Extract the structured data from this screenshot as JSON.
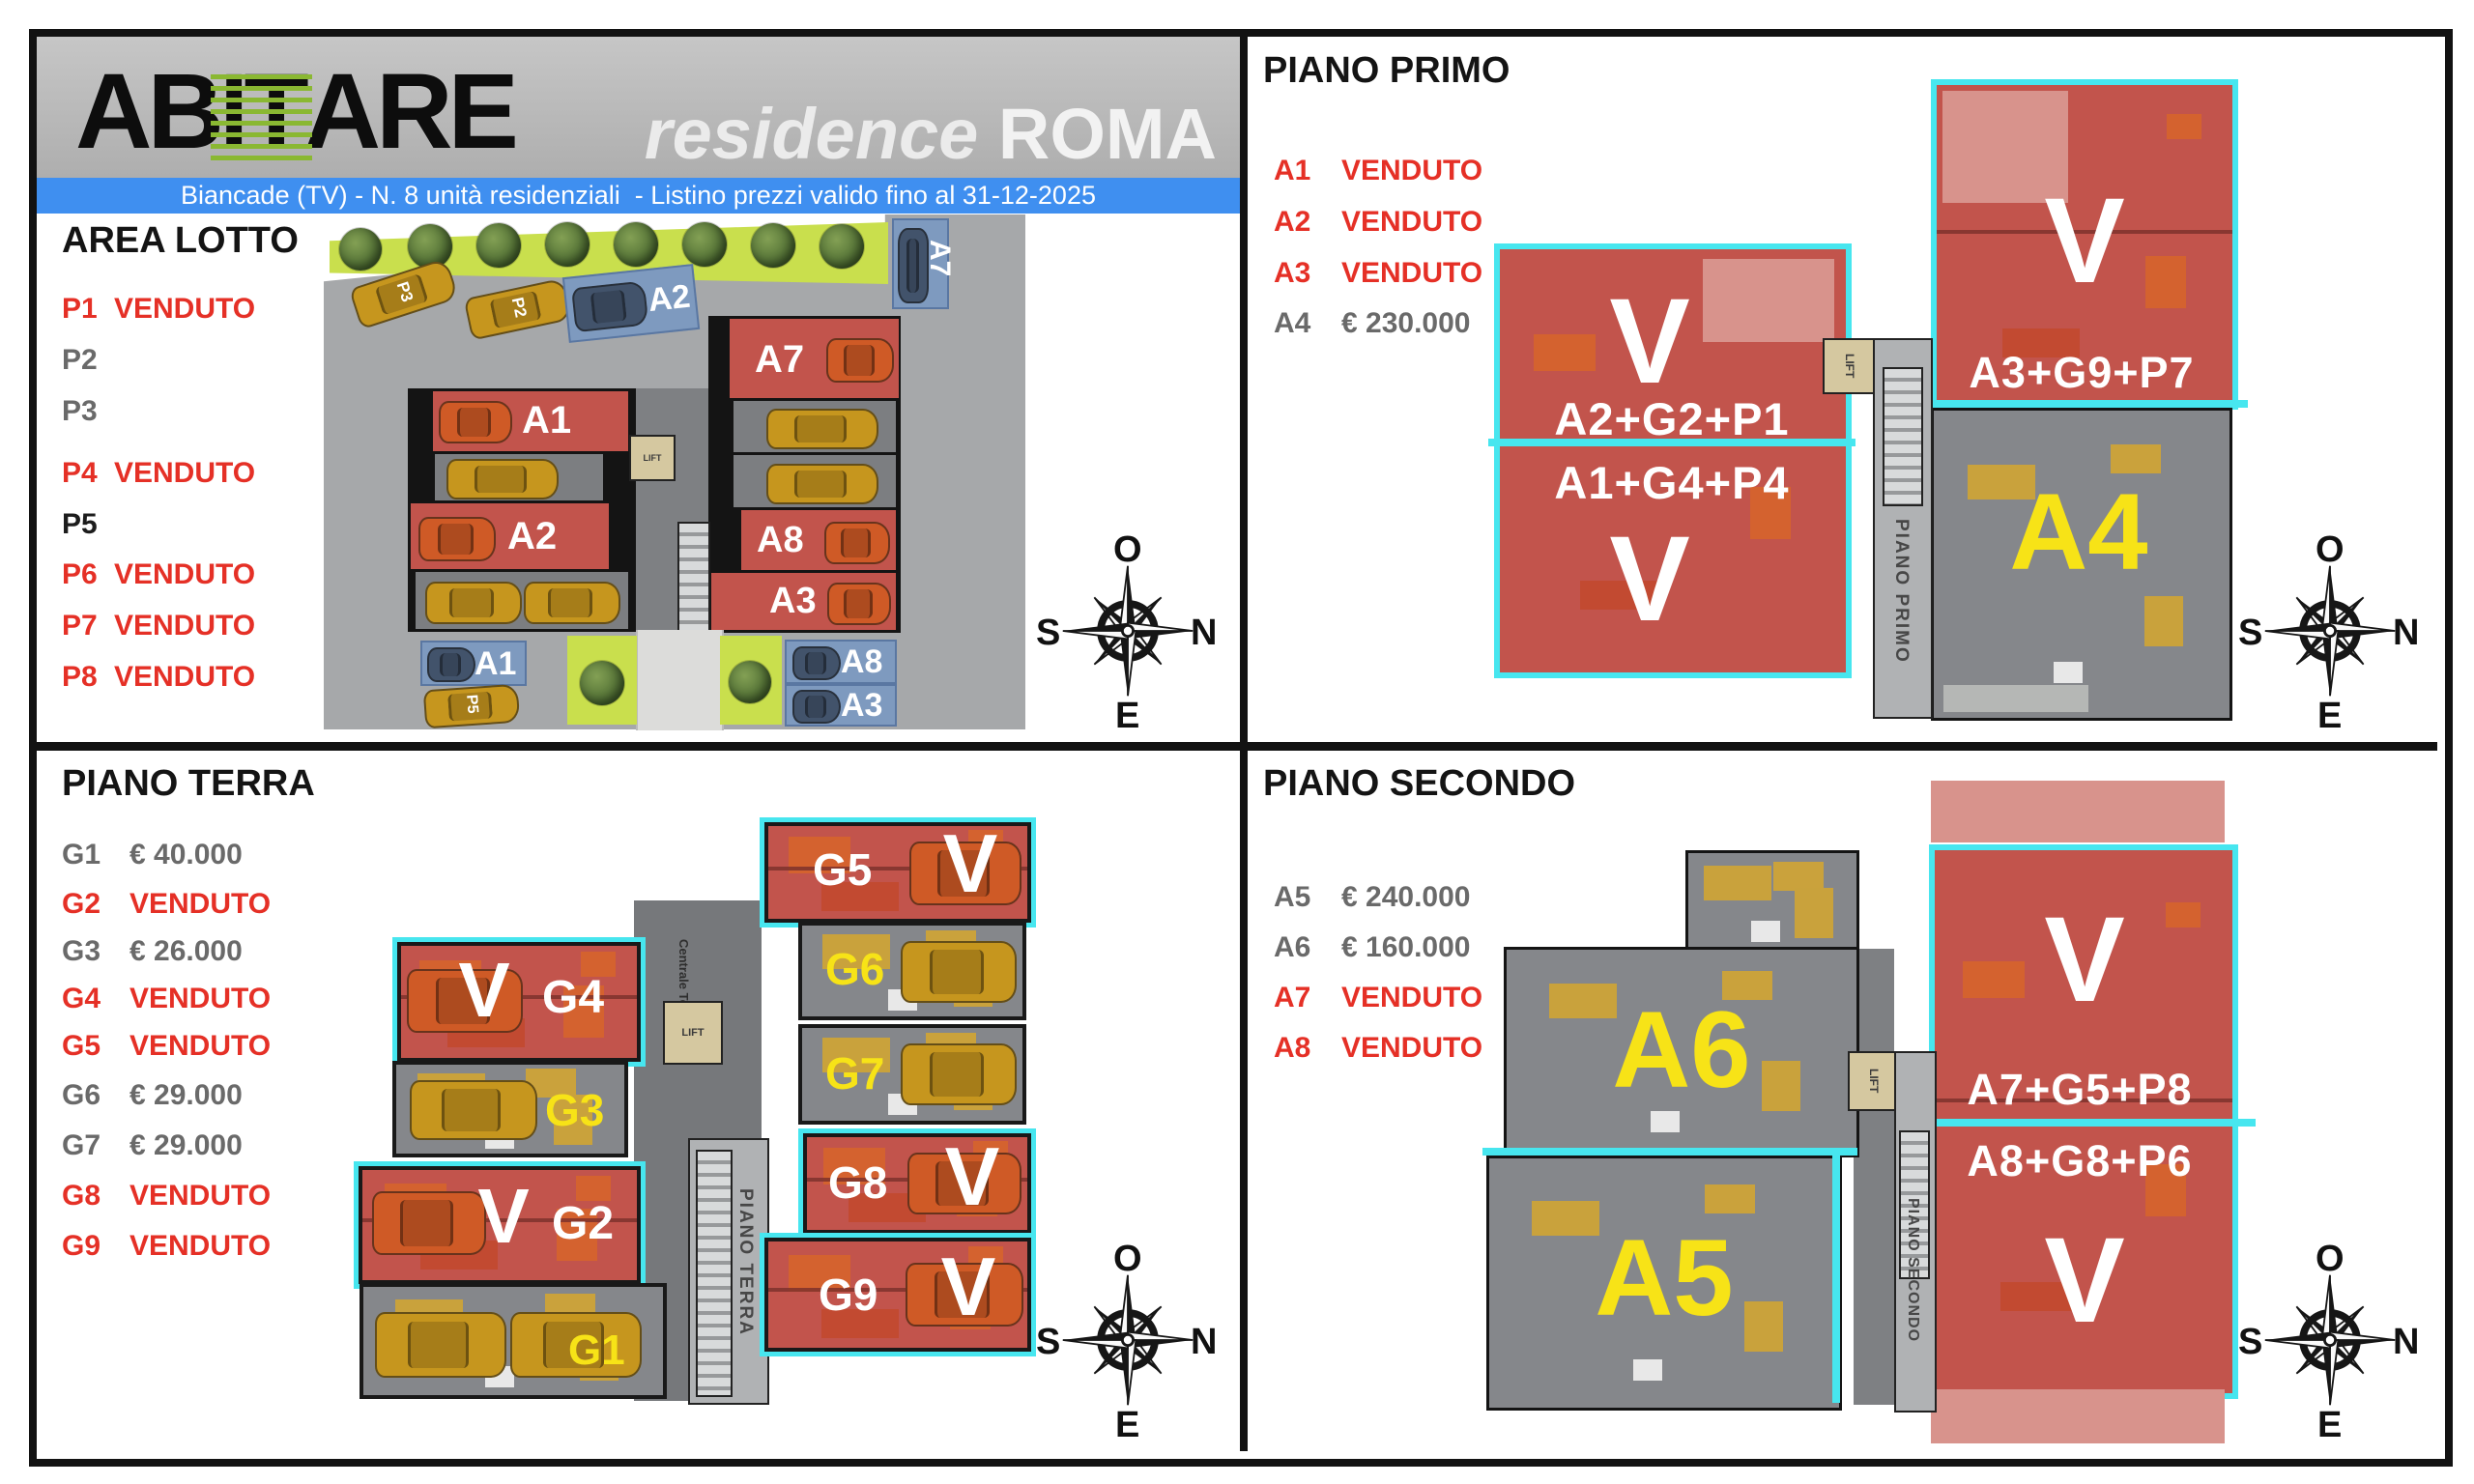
{
  "header": {
    "logo_ab": "AB",
    "logo_it": "IT",
    "logo_are": "ARE",
    "residence": "residence ",
    "roma": "ROMA",
    "banner": "Biancade (TV) - N. 8 unità residenziali  - Listino prezzi valido fino al 31-12-2025"
  },
  "colors": {
    "banner_blue": "#3f8ff0",
    "sold_red": "#e53026",
    "available_gray": "#6a6a6a",
    "plan_red": "#c2544c",
    "cyan_outline": "#47e6ef",
    "site_green": "#c9df4d",
    "parking_blue": "#7e9abf",
    "label_yellow": "#f7e317"
  },
  "area_lotto": {
    "title": "AREA LOTTO",
    "rows": [
      {
        "id": "P1",
        "value": "VENDUTO",
        "status": "sold"
      },
      {
        "id": "P2",
        "value": "",
        "status": "avail"
      },
      {
        "id": "P3",
        "value": "",
        "status": "avail"
      },
      {
        "id": "P4",
        "value": "VENDUTO",
        "status": "sold"
      },
      {
        "id": "P5",
        "value": "",
        "status": "dark"
      },
      {
        "id": "P6",
        "value": "VENDUTO",
        "status": "sold"
      },
      {
        "id": "P7",
        "value": "VENDUTO",
        "status": "sold"
      },
      {
        "id": "P8",
        "value": "VENDUTO",
        "status": "sold"
      }
    ],
    "plan": {
      "zone_line1": "AREA DI",
      "zone_line2": "LOTTIZZAZIONE",
      "unit_a1": "A1",
      "unit_a2": "A2",
      "unit_a7": "A7",
      "unit_a8": "A8",
      "unit_a3": "A3",
      "park_a7": "A7",
      "park_a2": "A2",
      "park_a1": "A1",
      "park_a8": "A8",
      "park_a3": "A3",
      "car_p3": "P3",
      "car_p2": "P2",
      "car_p5": "P5",
      "lift": "LIFT"
    }
  },
  "piano_primo": {
    "title": "PIANO PRIMO",
    "rows": [
      {
        "id": "A1",
        "value": "VENDUTO",
        "status": "sold"
      },
      {
        "id": "A2",
        "value": "VENDUTO",
        "status": "sold"
      },
      {
        "id": "A3",
        "value": "VENDUTO",
        "status": "sold"
      },
      {
        "id": "A4",
        "value": "€ 230.000",
        "status": "avail"
      }
    ],
    "plan": {
      "v": "V",
      "left_top_combo": "A2+G2+P1",
      "left_bottom_combo": "A1+G4+P4",
      "right_combo": "A3+G9+P7",
      "unit_a4": "A4",
      "lift": "LIFT",
      "shaft": "PIANO PRIMO"
    }
  },
  "piano_terra": {
    "title": "PIANO TERRA",
    "rows": [
      {
        "id": "G1",
        "value": "€ 40.000",
        "status": "avail"
      },
      {
        "id": "G2",
        "value": "VENDUTO",
        "status": "sold"
      },
      {
        "id": "G3",
        "value": "€ 26.000",
        "status": "avail"
      },
      {
        "id": "G4",
        "value": "VENDUTO",
        "status": "sold"
      },
      {
        "id": "G5",
        "value": "VENDUTO",
        "status": "sold"
      },
      {
        "id": "G6",
        "value": "€ 29.000",
        "status": "avail"
      },
      {
        "id": "G7",
        "value": "€ 29.000",
        "status": "avail"
      },
      {
        "id": "G8",
        "value": "VENDUTO",
        "status": "sold"
      },
      {
        "id": "G9",
        "value": "VENDUTO",
        "status": "sold"
      }
    ],
    "plan": {
      "v": "V",
      "g1": "G1",
      "g2": "G2",
      "g3": "G3",
      "g4": "G4",
      "g5": "G5",
      "g6": "G6",
      "g7": "G7",
      "g8": "G8",
      "g9": "G9",
      "centrale": "Centrale Termica",
      "lift": "LIFT",
      "shaft": "PIANO TERRA"
    }
  },
  "piano_secondo": {
    "title": "PIANO SECONDO",
    "rows": [
      {
        "id": "A5",
        "value": "€ 240.000",
        "status": "avail"
      },
      {
        "id": "A6",
        "value": "€ 160.000",
        "status": "avail"
      },
      {
        "id": "A7",
        "value": "VENDUTO",
        "status": "sold"
      },
      {
        "id": "A8",
        "value": "VENDUTO",
        "status": "sold"
      }
    ],
    "plan": {
      "v": "V",
      "unit_a5": "A5",
      "unit_a6": "A6",
      "right_top_combo": "A7+G5+P8",
      "right_bottom_combo": "A8+G8+P6",
      "lift": "LIFT",
      "shaft": "PIANO SECONDO"
    }
  },
  "compass": {
    "o": "O",
    "s": "S",
    "n": "N",
    "e": "E"
  }
}
